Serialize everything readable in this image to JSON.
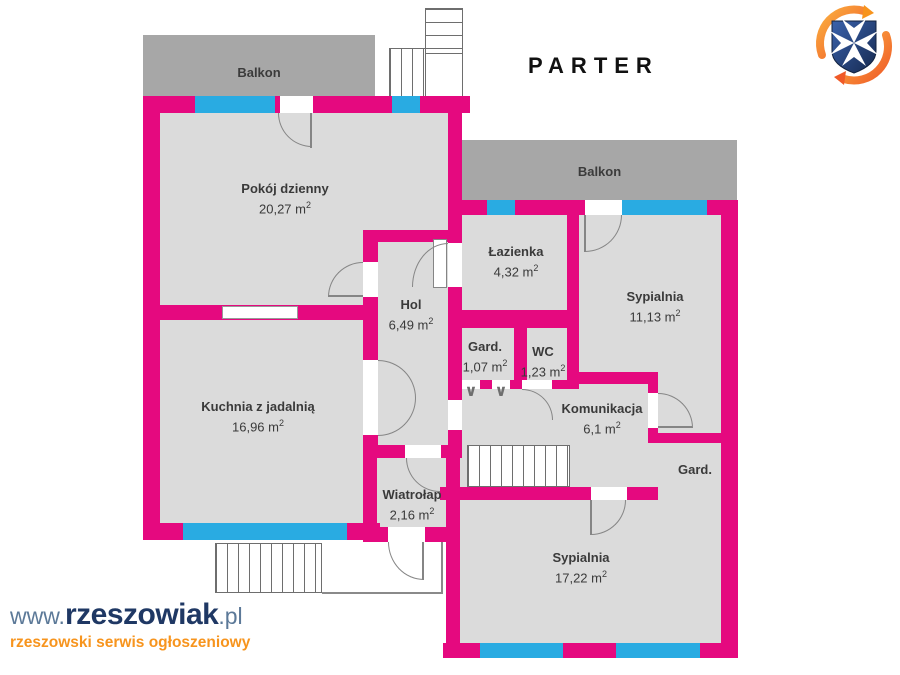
{
  "title": "PARTER",
  "sup": "2",
  "branding": {
    "site_www": "www.",
    "site_name": "rzeszowiak",
    "site_tld": ".pl",
    "tagline": "rzeszowski serwis ogłoszeniowy"
  },
  "colors": {
    "wall": "#E5097F",
    "window": "#29ABE2",
    "balcony": "#A7A7A7",
    "room_fill": "#DBDBDB",
    "outline": "#7a7a7a",
    "text": "#3A3A3A",
    "title": "#111111",
    "logo_navy": "#1F3864",
    "logo_gray_blue": "#5C7998",
    "logo_orange": "#F7941D",
    "emblem_blue": "#2B4C8C",
    "emblem_orange": "#F7941D"
  },
  "rooms": {
    "balkon_top": {
      "name": "Balkon"
    },
    "balkon_right": {
      "name": "Balkon"
    },
    "pokoj_dzienny": {
      "name": "Pokój dzienny",
      "area": "20,27 m"
    },
    "kuchnia": {
      "name": "Kuchnia z jadalnią",
      "area": "16,96 m"
    },
    "hol": {
      "name": "Hol",
      "area": "6,49 m"
    },
    "lazienka": {
      "name": "Łazienka",
      "area": "4,32 m"
    },
    "sypialnia_1": {
      "name": "Sypialnia",
      "area": "11,13 m"
    },
    "gard_1": {
      "name": "Gard.",
      "area": "1,07 m"
    },
    "wc": {
      "name": "WC",
      "area": "1,23 m"
    },
    "komunikacja": {
      "name": "Komunikacja",
      "area": "6,1 m"
    },
    "gard_2": {
      "name": "Gard."
    },
    "wiatrolap": {
      "name": "Wiatrołap",
      "area": "2,16 m"
    },
    "sypialnia_2": {
      "name": "Sypialnia",
      "area": "17,22 m"
    }
  }
}
